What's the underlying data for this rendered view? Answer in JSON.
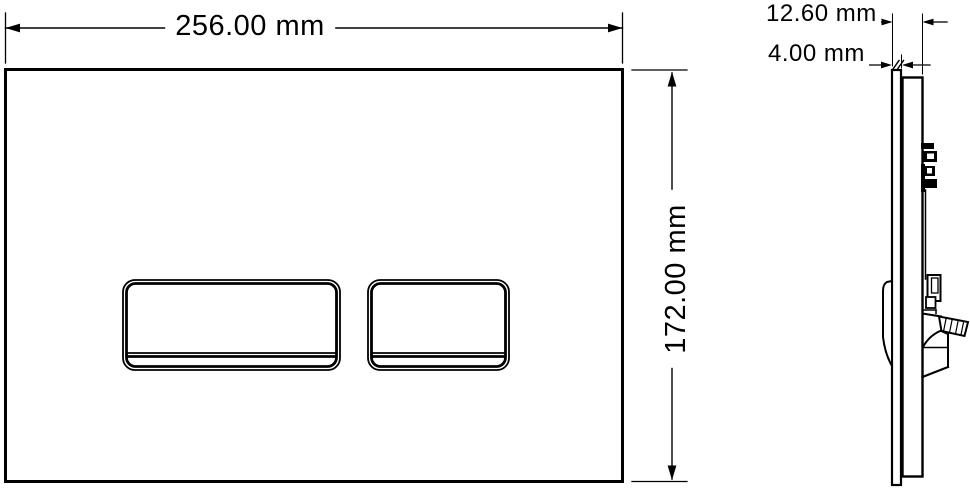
{
  "colors": {
    "background": "#ffffff",
    "line": "#000000"
  },
  "front_view": {
    "description": "flush plate front elevation with two buttons",
    "width_dimension_label": "256.00 mm",
    "width_value_mm": 256.0,
    "height_dimension_label": "172.00 mm",
    "height_value_mm": 172.0
  },
  "side_view": {
    "description": "flush plate side profile with mounting mechanism",
    "overall_depth_label": "12.60 mm",
    "overall_depth_value_mm": 12.6,
    "plate_thickness_label": "4.00 mm",
    "plate_thickness_value_mm": 4.0
  }
}
